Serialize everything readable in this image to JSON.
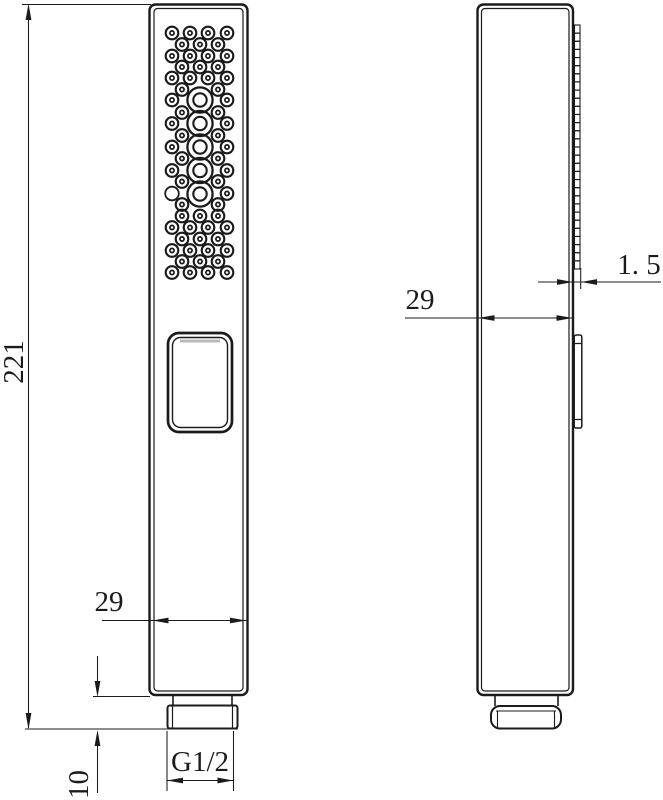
{
  "drawing": {
    "labels": {
      "overall_height": "221",
      "front_bottom_width": "29",
      "connector_height": "10",
      "thread_size": "G1/2",
      "side_width": "29",
      "plate_thickness": "1. 5"
    },
    "colors": {
      "line": "#1b1b1b",
      "button_shade": "#b9b9b9",
      "background": "#ffffff"
    },
    "front_nozzles": {
      "small_rows": [
        {
          "y": 33,
          "xs": [
            172,
            190,
            208,
            227
          ]
        },
        {
          "y": 44.5,
          "xs": [
            182,
            200,
            218
          ]
        },
        {
          "y": 56,
          "xs": [
            172,
            190,
            208,
            227
          ]
        },
        {
          "y": 67,
          "xs": [
            182,
            200,
            218
          ]
        },
        {
          "y": 78,
          "xs": [
            172,
            190,
            208,
            227
          ]
        },
        {
          "y": 89.5,
          "xs": [
            182,
            218
          ]
        },
        {
          "y": 100,
          "xs": [
            172,
            227
          ]
        },
        {
          "y": 112.5,
          "xs": [
            182,
            218
          ]
        },
        {
          "y": 123.5,
          "xs": [
            172,
            227
          ]
        },
        {
          "y": 135.5,
          "xs": [
            182,
            218
          ]
        },
        {
          "y": 147,
          "xs": [
            172,
            227
          ]
        },
        {
          "y": 158.5,
          "xs": [
            182,
            218
          ]
        },
        {
          "y": 170.5,
          "xs": [
            172,
            227
          ]
        },
        {
          "y": 181.5,
          "xs": [
            182,
            218
          ]
        },
        {
          "y": 193.5,
          "xs": [
            227
          ]
        },
        {
          "y": 204.5,
          "xs": [
            182,
            218
          ]
        },
        {
          "y": 216,
          "xs": [
            182,
            200,
            218
          ]
        },
        {
          "y": 227.5,
          "xs": [
            172,
            190,
            208,
            227
          ]
        },
        {
          "y": 239,
          "xs": [
            182,
            200,
            218
          ]
        },
        {
          "y": 250.5,
          "xs": [
            172,
            190,
            208,
            227
          ]
        },
        {
          "y": 261.5,
          "xs": [
            182,
            200,
            218
          ]
        },
        {
          "y": 272.5,
          "xs": [
            172,
            190,
            208,
            227
          ]
        }
      ],
      "big": {
        "x": 200,
        "ys": [
          100,
          123.5,
          147,
          170.5,
          194
        ]
      },
      "plain": [
        {
          "x": 172,
          "y": 193.5
        }
      ]
    },
    "side_strip": {
      "x": 574.5,
      "width": 5.5,
      "top": 25,
      "bottom": 269,
      "segments": 30
    }
  }
}
